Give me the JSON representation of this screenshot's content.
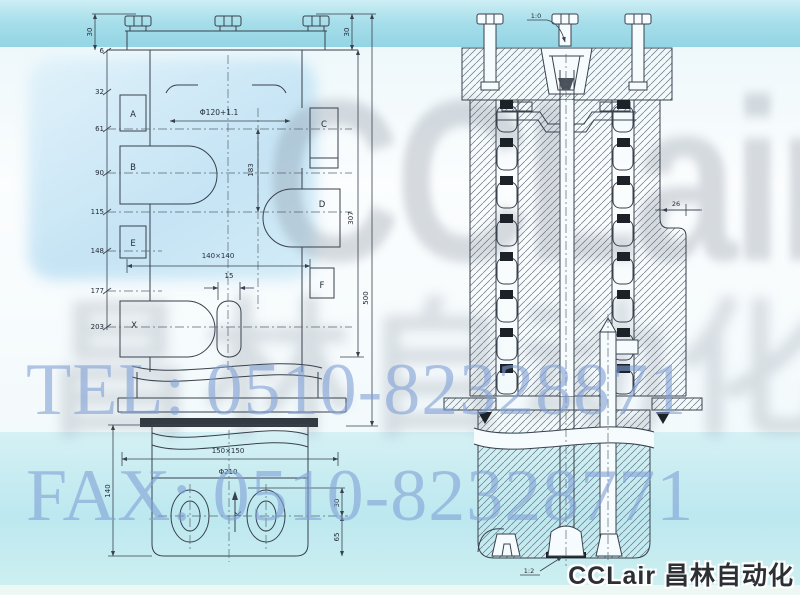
{
  "watermarks": {
    "brand": "CCLair",
    "brand_cn": "昌林自动化",
    "tel": "TEL: 0510-82328871",
    "fax": "FAX: 0510-82328771"
  },
  "footer": {
    "brand": "CCLair 昌林自动化"
  },
  "colors": {
    "band_cyan": "#9cd8e6",
    "watermark_blue": "#80a0d6",
    "line": "#39414d",
    "seal_black": "#1c2228"
  },
  "front_view": {
    "ladder_dims": [
      "6",
      "32",
      "61",
      "90",
      "115",
      "148",
      "177",
      "203"
    ],
    "ports": {
      "a": "A",
      "b": "B",
      "c": "C",
      "d": "D",
      "e": "E",
      "f": "F",
      "x": "X",
      "k": "K"
    },
    "dims": {
      "top_left": "30",
      "top_right": "30",
      "bore": "Φ120+1.1",
      "bore_span": "183",
      "body_height": "307",
      "total_height": "500",
      "square": "140×140",
      "slot_width": "15",
      "base_square": "150×150",
      "base_dia": "Φ210",
      "base_height": "140",
      "hole_top": "30",
      "hole_bottom": "65"
    }
  },
  "section_view": {
    "dims": {
      "taper_top": "1:0",
      "step_width": "26",
      "taper_bottom": "1:2"
    }
  }
}
